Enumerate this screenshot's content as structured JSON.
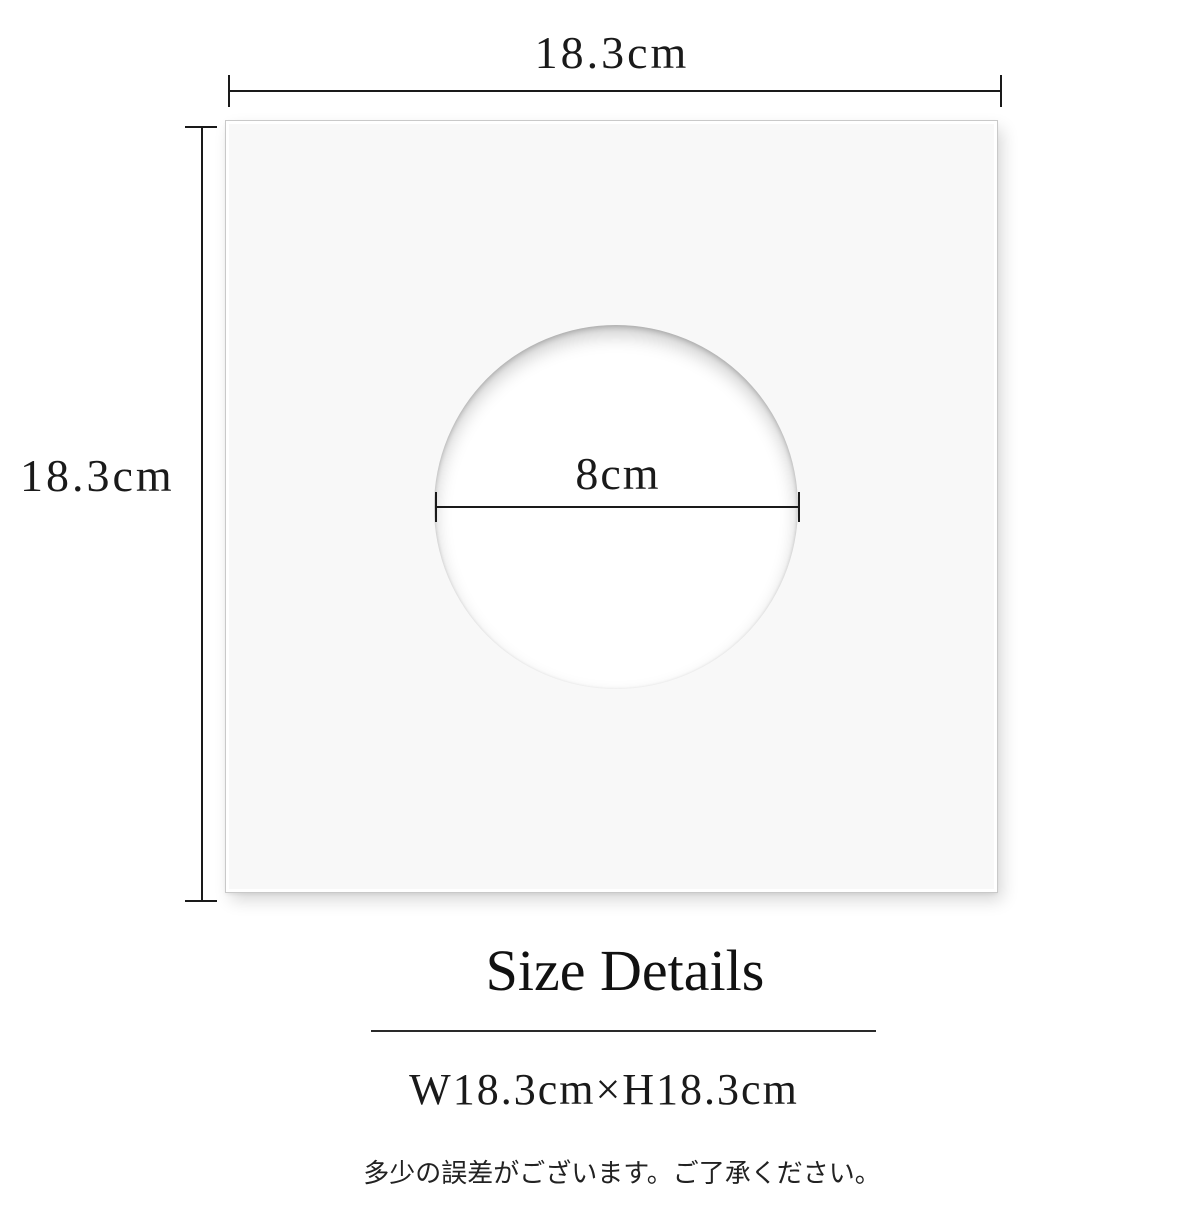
{
  "colors": {
    "background": "#ffffff",
    "board_fill": "#f8f8f8",
    "board_border": "#c9c9c9",
    "line": "#1a1a1a",
    "text": "#1a1a1a"
  },
  "diagram": {
    "width_label": "18.3cm",
    "height_label": "18.3cm",
    "hole_diameter_label": "8cm"
  },
  "details": {
    "title": "Size Details",
    "dimensions_text": "W18.3cm×H18.3cm",
    "note": "多少の誤差がございます。ご了承ください。"
  }
}
